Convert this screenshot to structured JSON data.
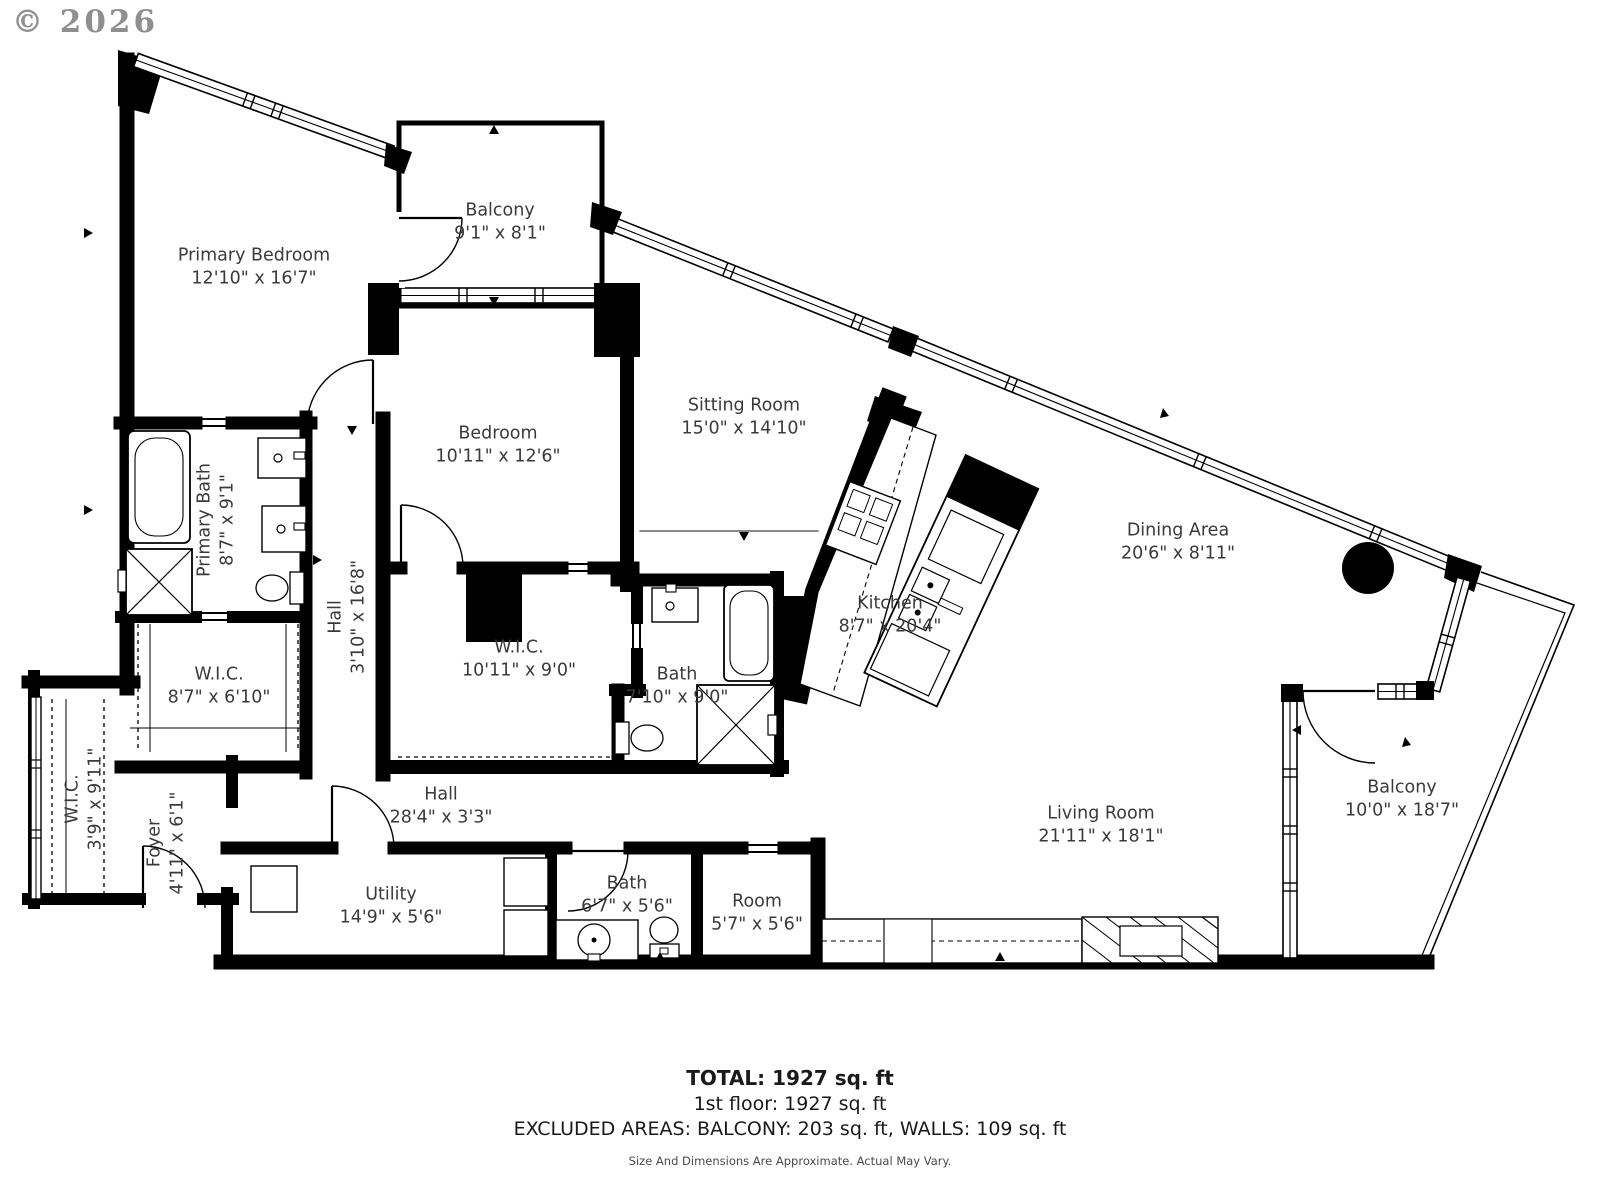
{
  "watermark": "© 2026",
  "rooms": [
    {
      "id": "primary-bedroom",
      "name": "Primary Bedroom",
      "dims": "12'10\" x 16'7\"",
      "x": 254,
      "y": 267,
      "rot": false
    },
    {
      "id": "balcony-top",
      "name": "Balcony",
      "dims": "9'1\" x 8'1\"",
      "x": 500,
      "y": 222,
      "rot": false
    },
    {
      "id": "bedroom",
      "name": "Bedroom",
      "dims": "10'11\" x 12'6\"",
      "x": 498,
      "y": 445,
      "rot": false
    },
    {
      "id": "sitting-room",
      "name": "Sitting Room",
      "dims": "15'0\" x 14'10\"",
      "x": 744,
      "y": 417,
      "rot": false
    },
    {
      "id": "primary-bath",
      "name": "Primary Bath",
      "dims": "8'7\" x 9'1\"",
      "x": 216,
      "y": 520,
      "rot": true
    },
    {
      "id": "hall-vertical",
      "name": "Hall",
      "dims": "3'10\" x 16'8\"",
      "x": 347,
      "y": 617,
      "rot": true
    },
    {
      "id": "wic-87",
      "name": "W.I.C.",
      "dims": "8'7\" x 6'10\"",
      "x": 219,
      "y": 686,
      "rot": false
    },
    {
      "id": "wic-1011",
      "name": "W.I.C.",
      "dims": "10'11\" x 9'0\"",
      "x": 519,
      "y": 659,
      "rot": false
    },
    {
      "id": "bath-710",
      "name": "Bath",
      "dims": "7'10\" x 9'0\"",
      "x": 677,
      "y": 686,
      "rot": false
    },
    {
      "id": "kitchen",
      "name": "Kitchen",
      "dims": "8'7\" x 20'4\"",
      "x": 890,
      "y": 615,
      "rot": false
    },
    {
      "id": "dining-area",
      "name": "Dining Area",
      "dims": "20'6\" x 8'11\"",
      "x": 1178,
      "y": 542,
      "rot": false
    },
    {
      "id": "wic-39",
      "name": "W.I.C.",
      "dims": "3'9\" x 9'11\"",
      "x": 84,
      "y": 799,
      "rot": true
    },
    {
      "id": "foyer",
      "name": "Foyer",
      "dims": "4'11\" x 6'1\"",
      "x": 166,
      "y": 843,
      "rot": true
    },
    {
      "id": "hall-horizontal",
      "name": "Hall",
      "dims": "28'4\" x 3'3\"",
      "x": 441,
      "y": 806,
      "rot": false
    },
    {
      "id": "utility",
      "name": "Utility",
      "dims": "14'9\" x 5'6\"",
      "x": 391,
      "y": 906,
      "rot": false
    },
    {
      "id": "bath-67",
      "name": "Bath",
      "dims": "6'7\" x 5'6\"",
      "x": 627,
      "y": 895,
      "rot": false
    },
    {
      "id": "room",
      "name": "Room",
      "dims": "5'7\" x 5'6\"",
      "x": 757,
      "y": 913,
      "rot": false
    },
    {
      "id": "living-room",
      "name": "Living Room",
      "dims": "21'11\" x 18'1\"",
      "x": 1101,
      "y": 825,
      "rot": false
    },
    {
      "id": "balcony-right",
      "name": "Balcony",
      "dims": "10'0\" x 18'7\"",
      "x": 1402,
      "y": 799,
      "rot": false
    }
  ],
  "summary": {
    "total": "TOTAL: 1927 sq. ft",
    "floor": "1st floor: 1927 sq. ft",
    "excluded": "EXCLUDED AREAS: BALCONY: 203 sq. ft, WALLS: 109 sq. ft",
    "disclaimer": "Size And Dimensions Are Approximate. Actual May Vary."
  },
  "colors": {
    "wall": "#000000",
    "text": "#3a3a3a",
    "watermark": "#8f8f8f"
  }
}
